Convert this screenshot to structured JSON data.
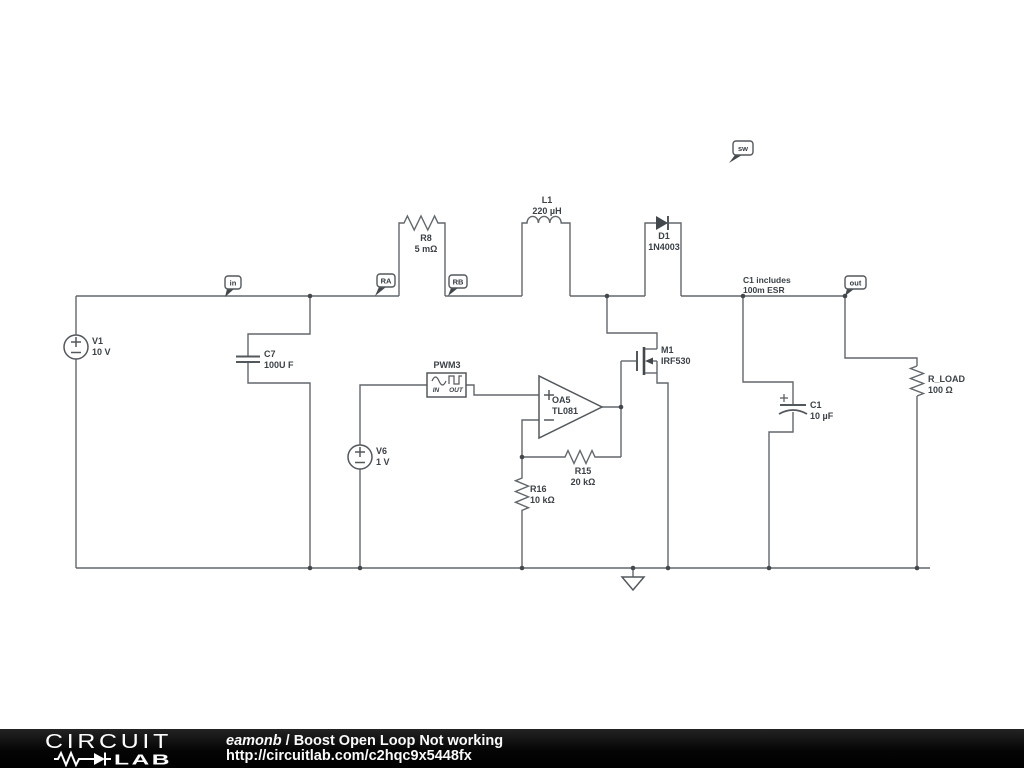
{
  "schematic": {
    "flags": {
      "in": {
        "label": "in"
      },
      "ra": {
        "label": "RA"
      },
      "rb": {
        "label": "RB"
      },
      "sw": {
        "label": "sw"
      },
      "out": {
        "label": "out"
      }
    },
    "components": {
      "v1": {
        "name": "V1",
        "value": "10 V"
      },
      "c7": {
        "name": "C7",
        "value": "100U F"
      },
      "r8": {
        "name": "R8",
        "value": "5 mΩ"
      },
      "l1": {
        "name": "L1",
        "value": "220 µH"
      },
      "d1": {
        "name": "D1",
        "value": "1N4003"
      },
      "m1": {
        "name": "M1",
        "value": "IRF530"
      },
      "pwm3": {
        "name": "PWM3",
        "in_label": "IN",
        "out_label": "OUT"
      },
      "oa5": {
        "name": "OA5",
        "value": "TL081"
      },
      "v6": {
        "name": "V6",
        "value": "1 V"
      },
      "r15": {
        "name": "R15",
        "value": "20 kΩ"
      },
      "r16": {
        "name": "R16",
        "value": "10 kΩ"
      },
      "c1": {
        "name": "C1",
        "value": "10 µF"
      },
      "r_load": {
        "name": "R_LOAD",
        "value": "100 Ω"
      }
    },
    "annotations": {
      "c1_note_line1": "C1 includes",
      "c1_note_line2": "100m ESR"
    }
  },
  "footer": {
    "logo_line1": "CIRCUIT",
    "logo_line2": "LAB",
    "author": "eamonb",
    "separator": "/",
    "title": "Boost Open Loop Not working",
    "url": "http://circuitlab.com/c2hqc9x5448fx"
  },
  "colors": {
    "wire": "#62676c",
    "symbol": "#53585d",
    "label_text": "#3b4147",
    "footer_bg": "#0a0a0a",
    "footer_text": "#fafafa",
    "canvas_bg": "#ffffff"
  }
}
